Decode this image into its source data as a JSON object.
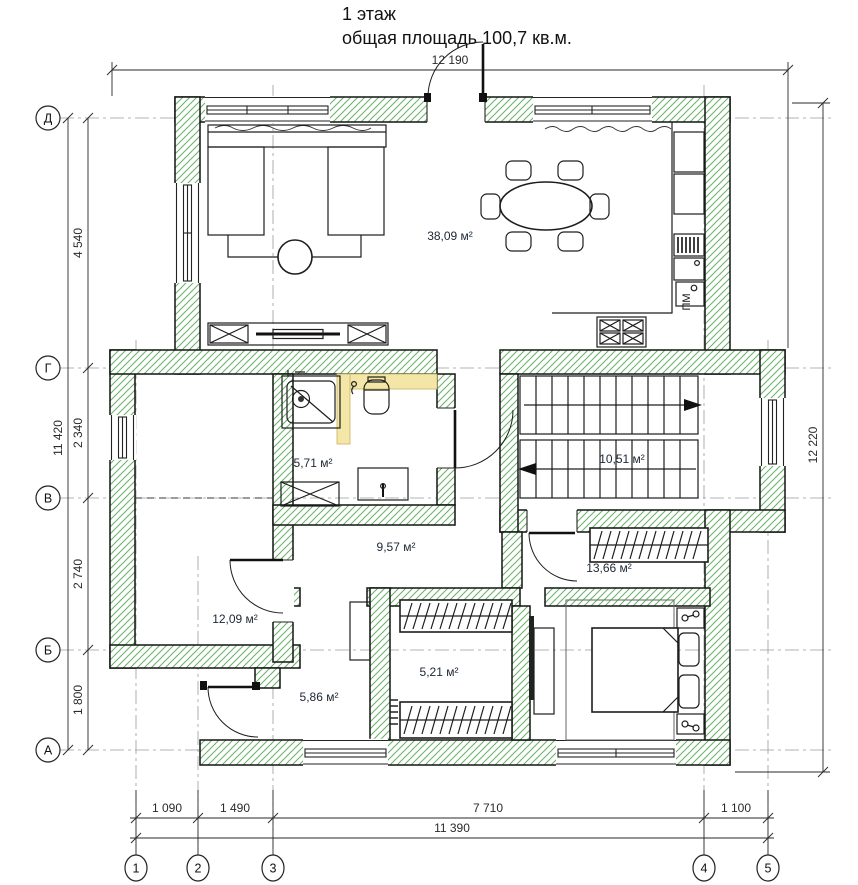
{
  "title": {
    "line1": "1 этаж",
    "line2": "общая площадь 100,7 кв.м."
  },
  "dimensions": {
    "top": "12 190",
    "right": "12 220",
    "left": {
      "total": "11 420",
      "d_g": "4 540",
      "g_v": "2 340",
      "v_b": "2 740",
      "b_a": "1 800"
    },
    "bottom": {
      "s1": "1 090",
      "s2": "1 490",
      "s3": "7 710",
      "s4": "1 100",
      "total": "11 390"
    }
  },
  "axes": {
    "horizontal": [
      "Д",
      "Г",
      "В",
      "Б",
      "А"
    ],
    "vertical": [
      "1",
      "2",
      "3",
      "4",
      "5"
    ]
  },
  "rooms": {
    "living_kitchen": "38,09 м²",
    "bathroom": "5,71 м²",
    "stairs": "10,51 м²",
    "hall": "9,57 м²",
    "wardrobe": "13,66 м²",
    "room_left": "12,09 м²",
    "closet": "5,21 м²",
    "hall_entry": "5,86 м²"
  },
  "labels": {
    "dishwasher": "ПМ"
  },
  "colors": {
    "wall_hatch": "#66b366",
    "outline": "#141414",
    "partition_yellow": "#f3e6a6",
    "axis_line": "#9b9b9b"
  }
}
